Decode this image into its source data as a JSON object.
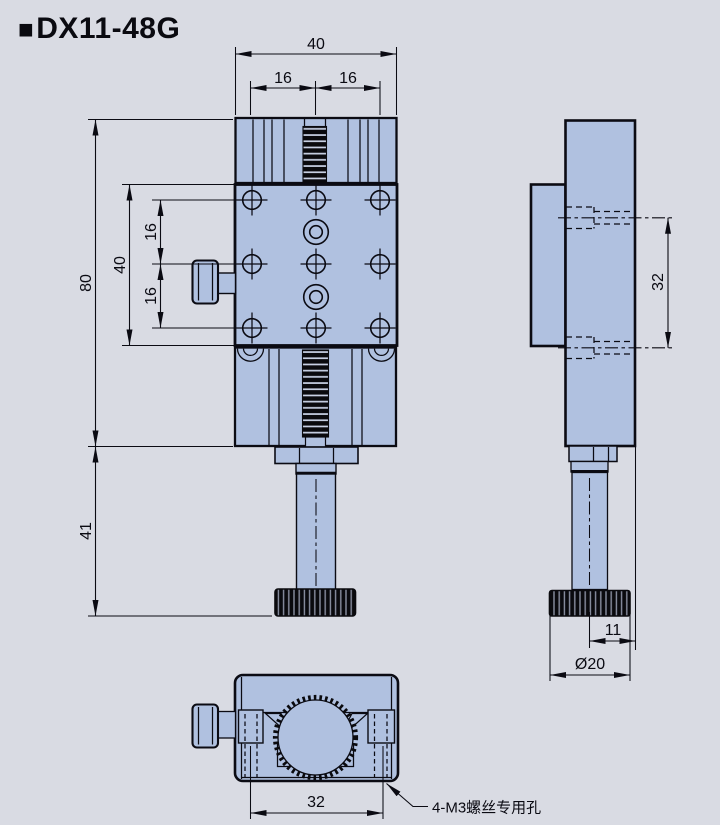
{
  "title": {
    "bullet": "■",
    "text": "DX11-48G"
  },
  "colors": {
    "background": "#d9dbe3",
    "part_fill": "#b0c1e0",
    "outline": "#0b0b13"
  },
  "front_view": {
    "dim_total_width": "40",
    "dim_top_pitch_left": "16",
    "dim_top_pitch_right": "16",
    "dim_total_height": "80",
    "dim_plate_height": "40",
    "dim_hole_pitch_upper": "16",
    "dim_hole_pitch_lower": "16",
    "dim_shaft_length": "41"
  },
  "side_view": {
    "dim_side_hole_span": "32",
    "dim_knob_offset": "11",
    "dim_knob_diameter": "Ø20"
  },
  "bottom_view": {
    "dim_slot_span": "32",
    "callout": "4-M3螺丝专用孔"
  }
}
